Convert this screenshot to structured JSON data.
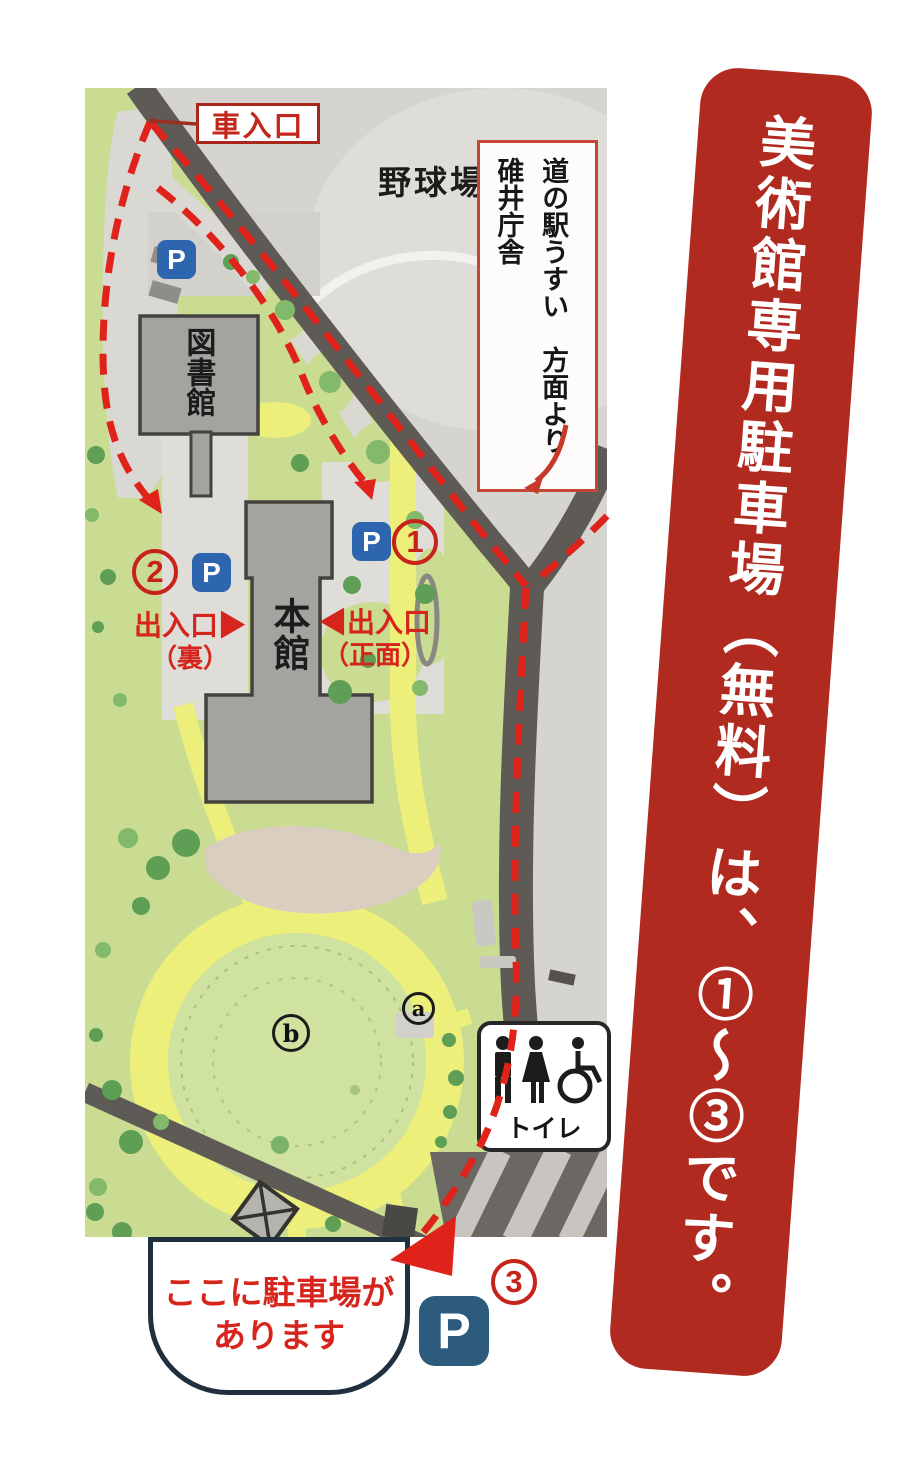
{
  "banner": {
    "text": "美術館専用駐車場（無料）は、①〜③です。"
  },
  "map": {
    "car_entrance": "車入口",
    "baseball_field": "野球場",
    "direction_note": "道の駅うすい　方面より\n碓井庁舎",
    "library": "図書館",
    "main_building": "本館",
    "exit_back_line1": "出入口▶",
    "exit_back_line2": "（裏）",
    "exit_front_line1": "◀出入口",
    "exit_front_line2": "（正面）",
    "toilet": "トイレ",
    "parking_symbol": "P",
    "route_numbers": [
      "1",
      "2",
      "3"
    ],
    "spots": {
      "a": "a",
      "b": "b"
    },
    "callout_line1": "ここに駐車場が",
    "callout_line2": "あります"
  },
  "colors": {
    "banner_red": "#b12a20",
    "route_red": "#e0231a",
    "label_red": "#d5251c",
    "parking_blue": "#2d66af",
    "parking_navy": "#2c5b7e"
  }
}
